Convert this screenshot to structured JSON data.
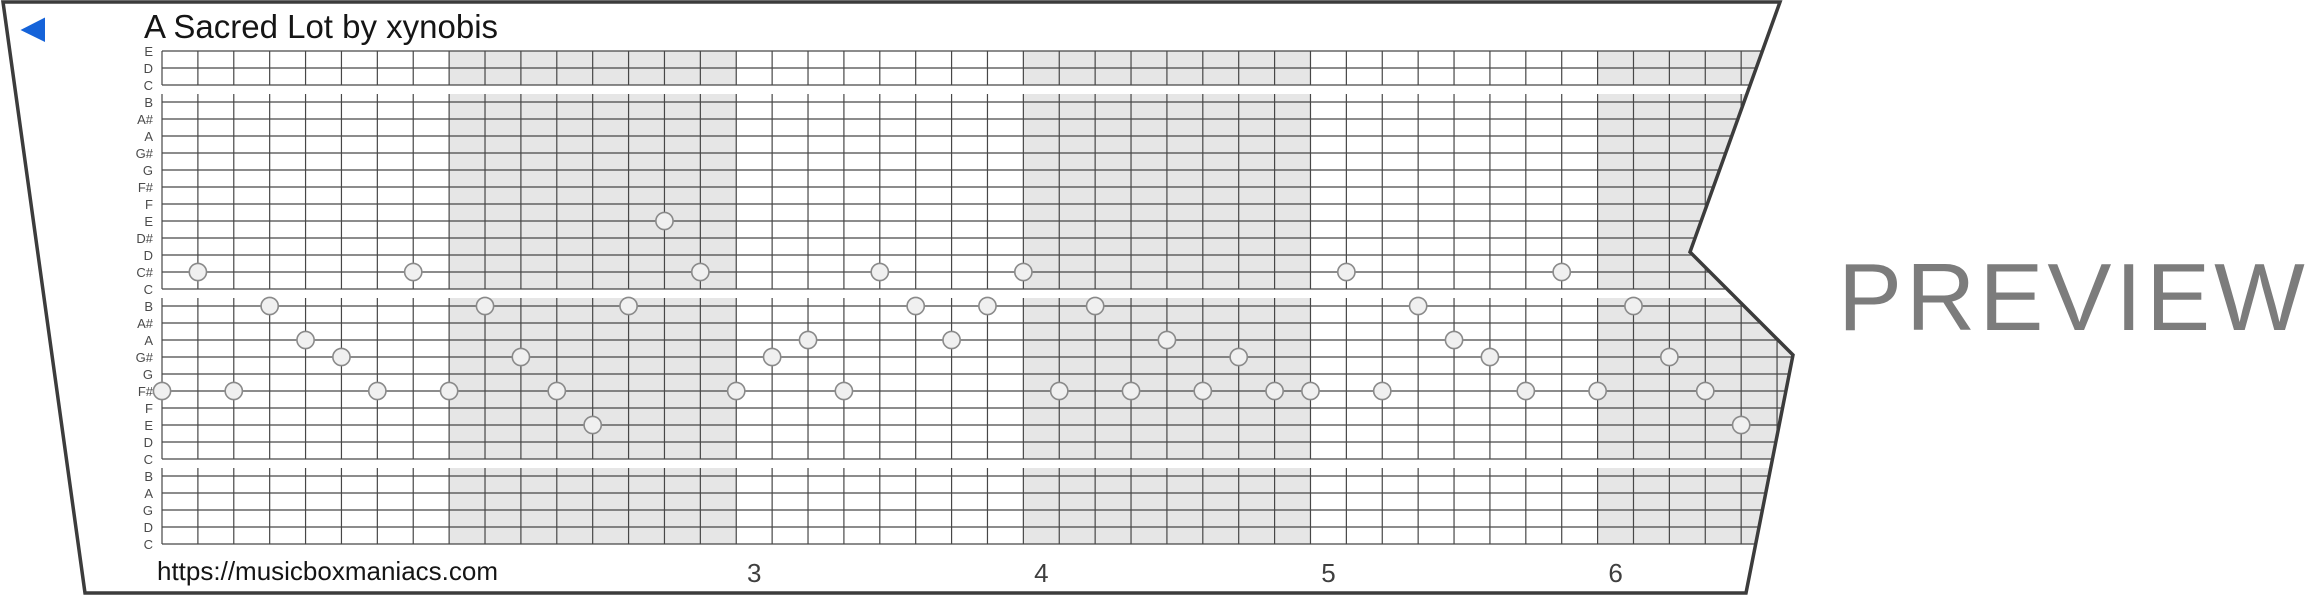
{
  "strip": {
    "title": "A Sacred Lot by xynobis",
    "url": "https://musicboxmaniacs.com",
    "note_labels": [
      "E",
      "D",
      "C",
      "B",
      "A#",
      "A",
      "G#",
      "G",
      "F#",
      "F",
      "E",
      "D#",
      "D",
      "C#",
      "C",
      "B",
      "A#",
      "A",
      "G#",
      "G",
      "F#",
      "F",
      "E",
      "D",
      "C",
      "B",
      "A",
      "G",
      "D",
      "C"
    ],
    "measure_numbers": [
      {
        "label": "3",
        "measure": 3
      },
      {
        "label": "4",
        "measure": 4
      },
      {
        "label": "5",
        "measure": 5
      },
      {
        "label": "6",
        "measure": 6
      }
    ],
    "notes": [
      {
        "beat": 0,
        "row": 20,
        "note": "F#"
      },
      {
        "beat": 1,
        "row": 13,
        "note": "C#"
      },
      {
        "beat": 2,
        "row": 20,
        "note": "F#"
      },
      {
        "beat": 3,
        "row": 15,
        "note": "B"
      },
      {
        "beat": 4,
        "row": 17,
        "note": "A"
      },
      {
        "beat": 5,
        "row": 18,
        "note": "G#"
      },
      {
        "beat": 6,
        "row": 20,
        "note": "F#"
      },
      {
        "beat": 7,
        "row": 13,
        "note": "C#"
      },
      {
        "beat": 8,
        "row": 20,
        "note": "F#"
      },
      {
        "beat": 9,
        "row": 15,
        "note": "B"
      },
      {
        "beat": 10,
        "row": 18,
        "note": "G#"
      },
      {
        "beat": 11,
        "row": 20,
        "note": "F#"
      },
      {
        "beat": 12,
        "row": 22,
        "note": "E"
      },
      {
        "beat": 13,
        "row": 15,
        "note": "B"
      },
      {
        "beat": 14,
        "row": 10,
        "note": "E"
      },
      {
        "beat": 15,
        "row": 13,
        "note": "C#"
      },
      {
        "beat": 16,
        "row": 20,
        "note": "F#"
      },
      {
        "beat": 17,
        "row": 18,
        "note": "G#"
      },
      {
        "beat": 18,
        "row": 17,
        "note": "A"
      },
      {
        "beat": 19,
        "row": 20,
        "note": "F#"
      },
      {
        "beat": 20,
        "row": 13,
        "note": "C#"
      },
      {
        "beat": 21,
        "row": 15,
        "note": "B"
      },
      {
        "beat": 22,
        "row": 17,
        "note": "A"
      },
      {
        "beat": 23,
        "row": 15,
        "note": "B"
      },
      {
        "beat": 24,
        "row": 13,
        "note": "C#"
      },
      {
        "beat": 25,
        "row": 20,
        "note": "F#"
      },
      {
        "beat": 26,
        "row": 15,
        "note": "B"
      },
      {
        "beat": 27,
        "row": 20,
        "note": "F#"
      },
      {
        "beat": 28,
        "row": 17,
        "note": "A"
      },
      {
        "beat": 29,
        "row": 20,
        "note": "F#"
      },
      {
        "beat": 30,
        "row": 18,
        "note": "G#"
      },
      {
        "beat": 31,
        "row": 20,
        "note": "F#"
      },
      {
        "beat": 32,
        "row": 20,
        "note": "F#"
      },
      {
        "beat": 33,
        "row": 13,
        "note": "C#"
      },
      {
        "beat": 34,
        "row": 20,
        "note": "F#"
      },
      {
        "beat": 35,
        "row": 15,
        "note": "B"
      },
      {
        "beat": 36,
        "row": 17,
        "note": "A"
      },
      {
        "beat": 37,
        "row": 18,
        "note": "G#"
      },
      {
        "beat": 38,
        "row": 20,
        "note": "F#"
      },
      {
        "beat": 39,
        "row": 13,
        "note": "C#"
      },
      {
        "beat": 40,
        "row": 20,
        "note": "F#"
      },
      {
        "beat": 41,
        "row": 15,
        "note": "B"
      },
      {
        "beat": 42,
        "row": 18,
        "note": "G#"
      },
      {
        "beat": 43,
        "row": 20,
        "note": "F#"
      },
      {
        "beat": 44,
        "row": 22,
        "note": "E"
      }
    ]
  },
  "watermark": {
    "text": "PREVIEW"
  },
  "icons": {
    "back_arrow": "left-triangle"
  },
  "colors": {
    "accent_blue": "#1563d9",
    "strip_border": "#3c3c3c",
    "grid_line": "#474747",
    "measure_shading": "#e6e6e6",
    "hole_fill": "#f0f0f0",
    "hole_stroke": "#8a8a8a",
    "watermark_gray": "#7c7c7c"
  },
  "layout": {
    "width": 2310,
    "height": 597,
    "outline": [
      [
        3,
        2
      ],
      [
        1780,
        2
      ],
      [
        1690,
        252
      ],
      [
        1793,
        355
      ],
      [
        1746,
        593
      ],
      [
        85,
        593
      ]
    ],
    "grid": {
      "x0": 162,
      "beat_w": 35.89,
      "beats": 46,
      "row0_y": 51,
      "row_h": 17,
      "rows": 30,
      "right_max": 1800,
      "blocks": [
        [
          51,
          85
        ],
        [
          94,
          289
        ],
        [
          298,
          459
        ],
        [
          468,
          544
        ]
      ],
      "measure_beats": 8,
      "shaded_measures": [
        2,
        4,
        6
      ],
      "hole_radius": 8.6,
      "number_offset_x": 18
    },
    "label_right_x": 153,
    "arrow": [
      [
        45,
        17.5
      ],
      [
        45,
        42
      ],
      [
        20.5,
        30
      ]
    ]
  }
}
